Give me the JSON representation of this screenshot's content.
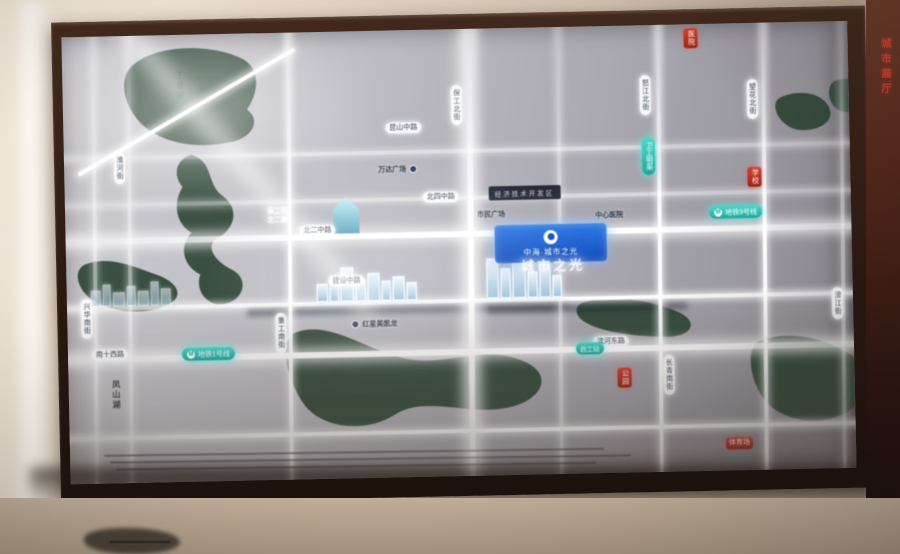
{
  "display": {
    "project_badge": {
      "name": "中海·城市之光",
      "logo": "circle-logo"
    },
    "project_glow_text": "城市之光",
    "district_bar": "经济技术开发区",
    "metro_badges": [
      {
        "text": "地铁9号线"
      },
      {
        "text": "地铁1号线"
      },
      {
        "text": "卫工明渠"
      },
      {
        "text": "启工站"
      }
    ],
    "road_labels_vertical": [
      {
        "text": "保工北街"
      },
      {
        "text": "怒江北街"
      },
      {
        "text": "望花北街"
      },
      {
        "text": "兴华南街"
      },
      {
        "text": "重工南街"
      },
      {
        "text": "长青南街"
      },
      {
        "text": "滂江街"
      },
      {
        "text": "淮河街"
      }
    ],
    "road_labels_horizontal": [
      {
        "text": "北二中路"
      },
      {
        "text": "昆山中路"
      },
      {
        "text": "建设中路"
      },
      {
        "text": "南十西路"
      },
      {
        "text": "滨河东路"
      },
      {
        "text": "北四中路"
      }
    ],
    "poi_labels": [
      {
        "text": "红星美凯龙"
      },
      {
        "text": "万达广场"
      },
      {
        "text": "市民广场"
      },
      {
        "text": "中心医院"
      }
    ],
    "red_badges": [
      {
        "text": "医院"
      },
      {
        "text": "学校"
      },
      {
        "text": "公园"
      },
      {
        "text": "体育场"
      }
    ],
    "nature_labels": [
      {
        "text": "丁香湖"
      },
      {
        "text": "凤山湖"
      }
    ],
    "station_label": {
      "line1": "保工街",
      "line2": "北二路"
    },
    "wall_sign_text": "城市展厅",
    "colors": {
      "project_blue": "#134dbc",
      "metro_teal": "#1ea89d",
      "badge_red": "#c0392b",
      "road_glow": "#ffffff",
      "park_green": "#2e4636",
      "wall_beige": "#d8c9b4",
      "frame_brown": "#2a1810"
    }
  }
}
